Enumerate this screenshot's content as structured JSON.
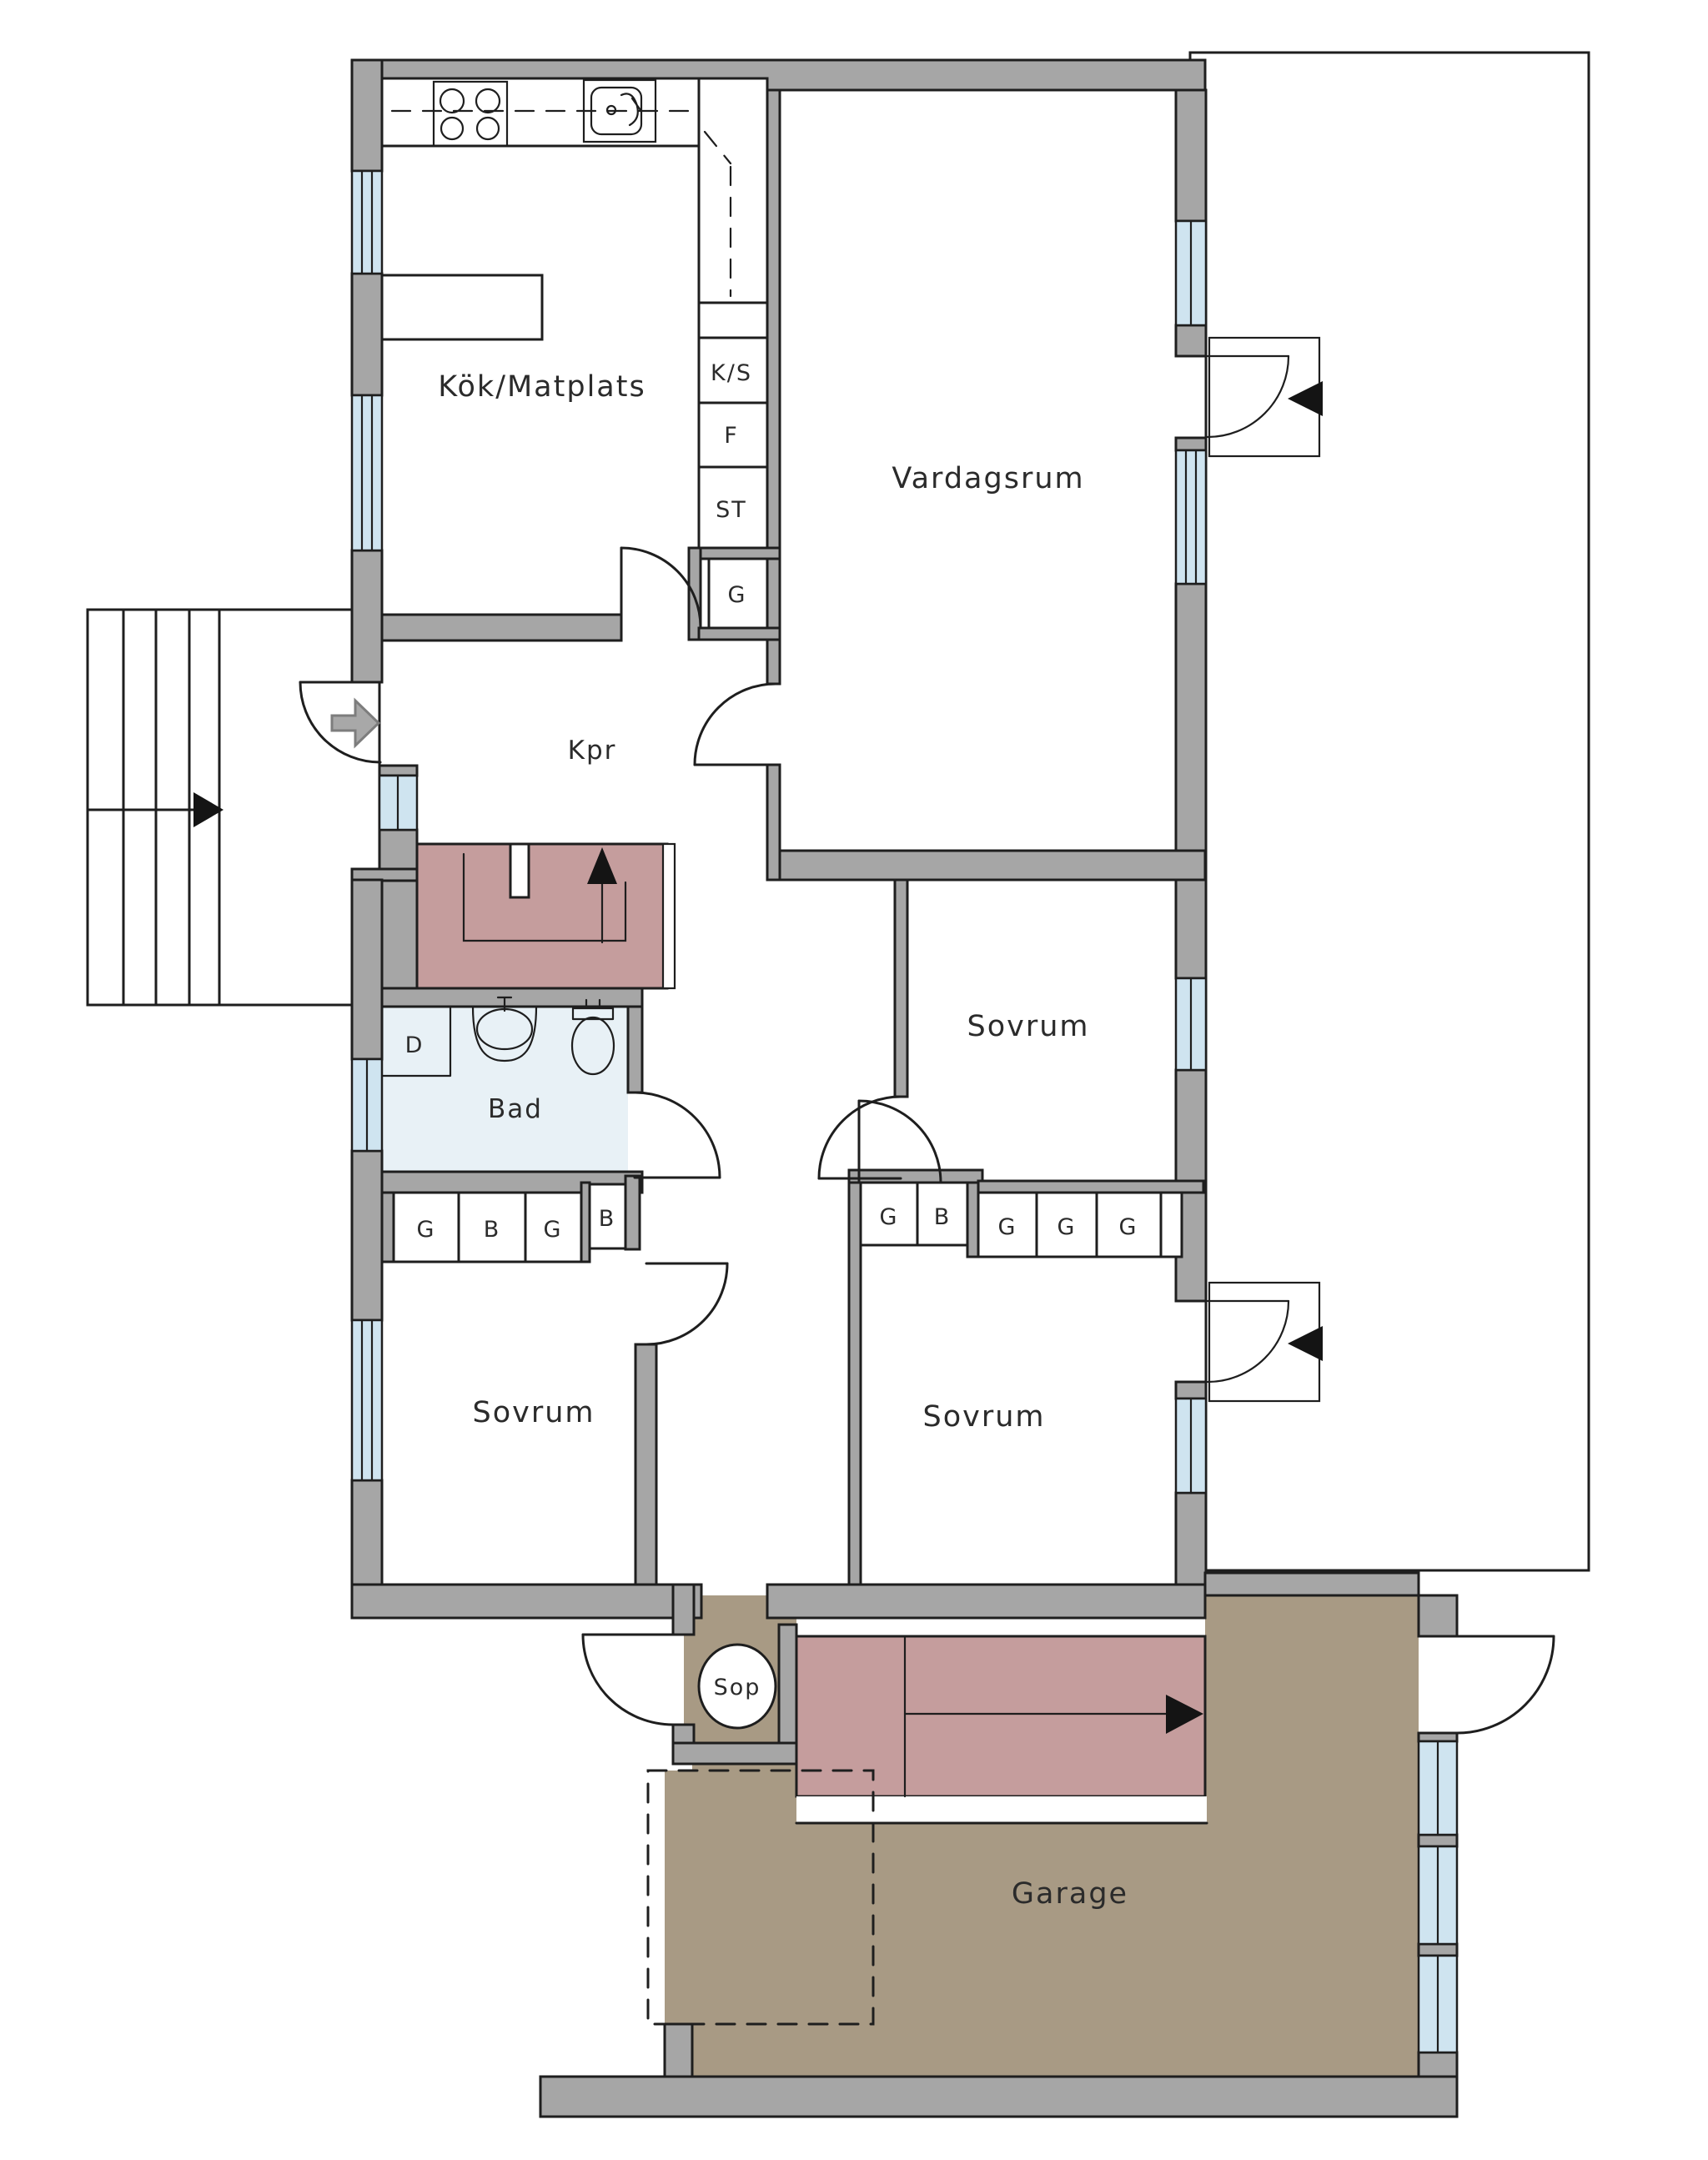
{
  "plan": {
    "type": "floorplan",
    "language": "sv",
    "rooms": {
      "kitchen": {
        "label": "Kök/Matplats"
      },
      "living": {
        "label": "Vardagsrum"
      },
      "hall": {
        "label": "Kpr"
      },
      "bath": {
        "label": "Bad"
      },
      "shower": {
        "label": "D"
      },
      "bedroom_right": {
        "label": "Sovrum"
      },
      "bedroom_left": {
        "label": "Sovrum"
      },
      "bedroom_middle": {
        "label": "Sovrum"
      },
      "waste": {
        "label": "Sop"
      },
      "garage": {
        "label": "Garage"
      }
    },
    "cabinets": {
      "ks": "K/S",
      "f": "F",
      "st": "ST",
      "g": "G"
    },
    "closets": {
      "bath_row": [
        "G",
        "B",
        "G",
        "B"
      ],
      "middle_row_left": [
        "G",
        "B"
      ],
      "middle_row_right": [
        "G",
        "G",
        "G"
      ]
    },
    "icons": {
      "stairs_up": "black triangle arrow up",
      "stairs_down_garage": "black triangle arrow right",
      "outdoor_steps": "black triangle arrow right",
      "entry": "grey block arrow right",
      "patio_entries": "black triangle arrows left",
      "stove": "4 burner circles",
      "sink": "basin with faucet",
      "toilet": "bowl with tank",
      "washbasin": "half oval with tap"
    }
  },
  "colors": {
    "paper": "#ffffff",
    "line": "#1e1e1e",
    "wall": "#a6a6a6",
    "window": "#cfe4f0",
    "bath_floor": "#e8f1f6",
    "stairs": "#c59d9d",
    "garage_floor": "#a89a84",
    "deck_base": "#c7bba2",
    "deck_light": "#cec3ab",
    "deck_dark": "#bfb297",
    "entry_arrow": "#a8a8a8"
  }
}
